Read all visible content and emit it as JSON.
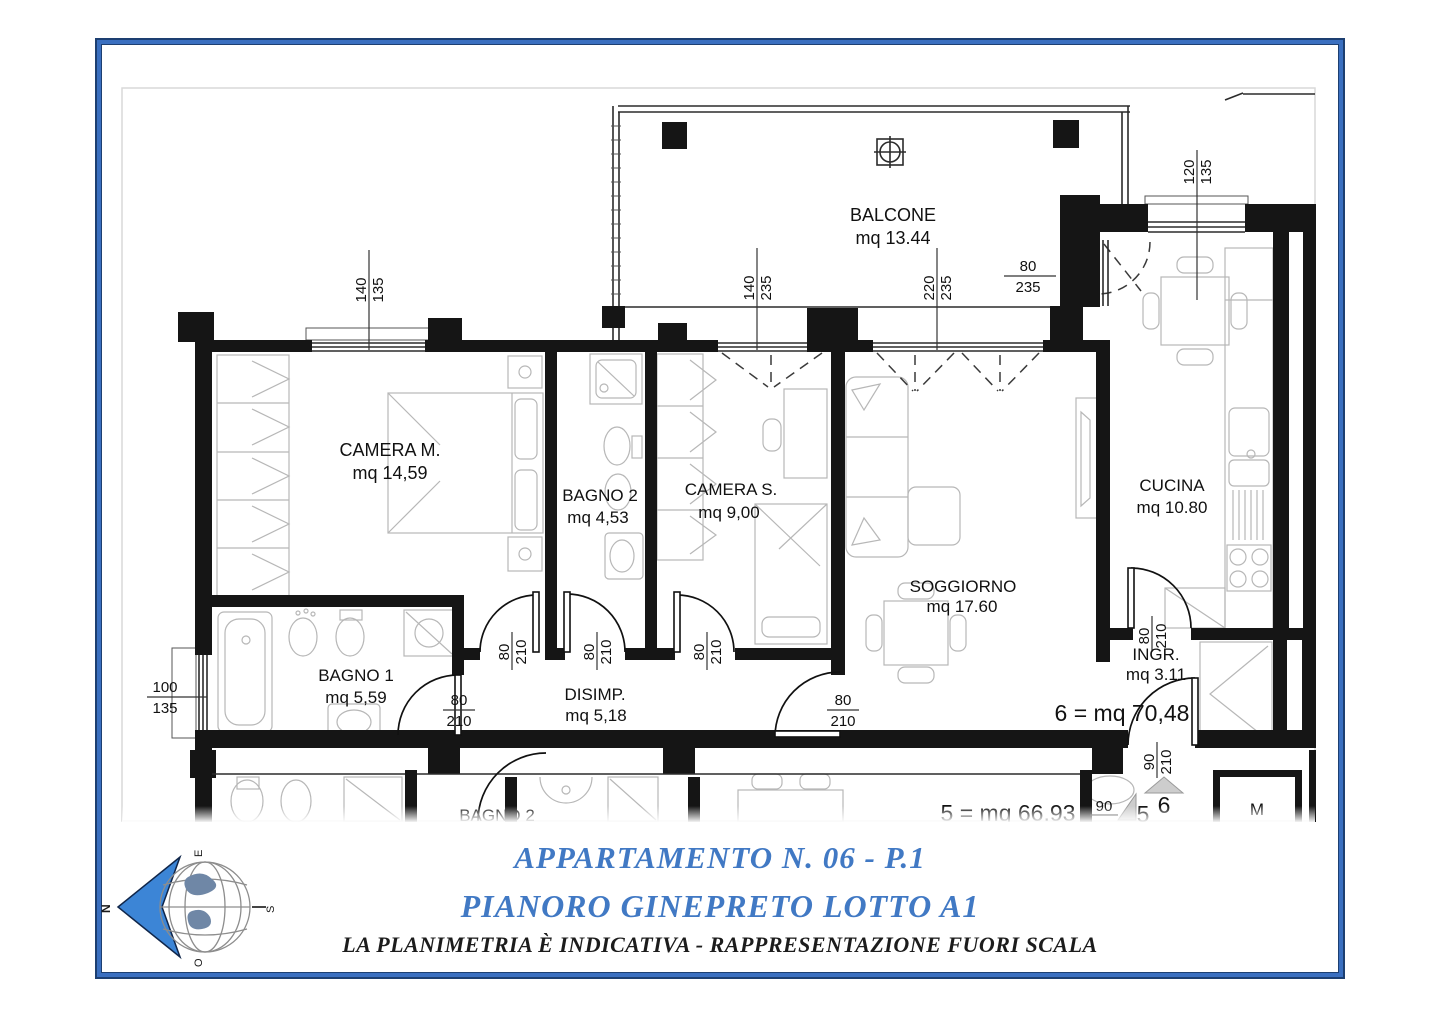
{
  "titles": {
    "line1": "APPARTAMENTO N. 06 - P.1",
    "line2": "PIANORO GINEPRETO LOTTO A1",
    "disclaimer": "LA PLANIMETRIA È INDICATIVA - RAPPRESENTAZIONE FUORI SCALA"
  },
  "compass": {
    "north": "N",
    "east": "E",
    "south": "S",
    "west": "O"
  },
  "rooms": [
    {
      "name": "BALCONE",
      "area": "mq 13.44"
    },
    {
      "name": "CAMERA M.",
      "area": "mq 14,59"
    },
    {
      "name": "BAGNO 2",
      "area": "mq 4,53"
    },
    {
      "name": "CAMERA S.",
      "area": "mq 9,00"
    },
    {
      "name": "SOGGIORNO",
      "area": "mq 17.60"
    },
    {
      "name": "CUCINA",
      "area": "mq 10.80"
    },
    {
      "name": "BAGNO 1",
      "area": "mq 5,59"
    },
    {
      "name": "DISIMP.",
      "area": "mq 5,18"
    },
    {
      "name": "INGR.",
      "area": "mq 3.11"
    }
  ],
  "dims": [
    {
      "a": "140",
      "b": "135"
    },
    {
      "a": "140",
      "b": "235"
    },
    {
      "a": "220",
      "b": "235"
    },
    {
      "a": "80",
      "b": "235"
    },
    {
      "a": "120",
      "b": "135"
    },
    {
      "a": "100",
      "b": "135"
    },
    {
      "a": "80",
      "b": "210"
    },
    {
      "a": "80",
      "b": "210"
    },
    {
      "a": "80",
      "b": "210"
    },
    {
      "a": "80",
      "b": "210"
    },
    {
      "a": "80",
      "b": "210"
    },
    {
      "a": "80",
      "b": "210"
    },
    {
      "a": "90",
      "b": "210"
    },
    {
      "a": "90"
    }
  ],
  "annotations": {
    "apt6_total": "6 = mq 70,48",
    "apt5_total": "5 = mq 66.93",
    "unit5": "5",
    "unit6": "6",
    "storage": "M",
    "lower_bagno2": "BAGNO 2"
  }
}
